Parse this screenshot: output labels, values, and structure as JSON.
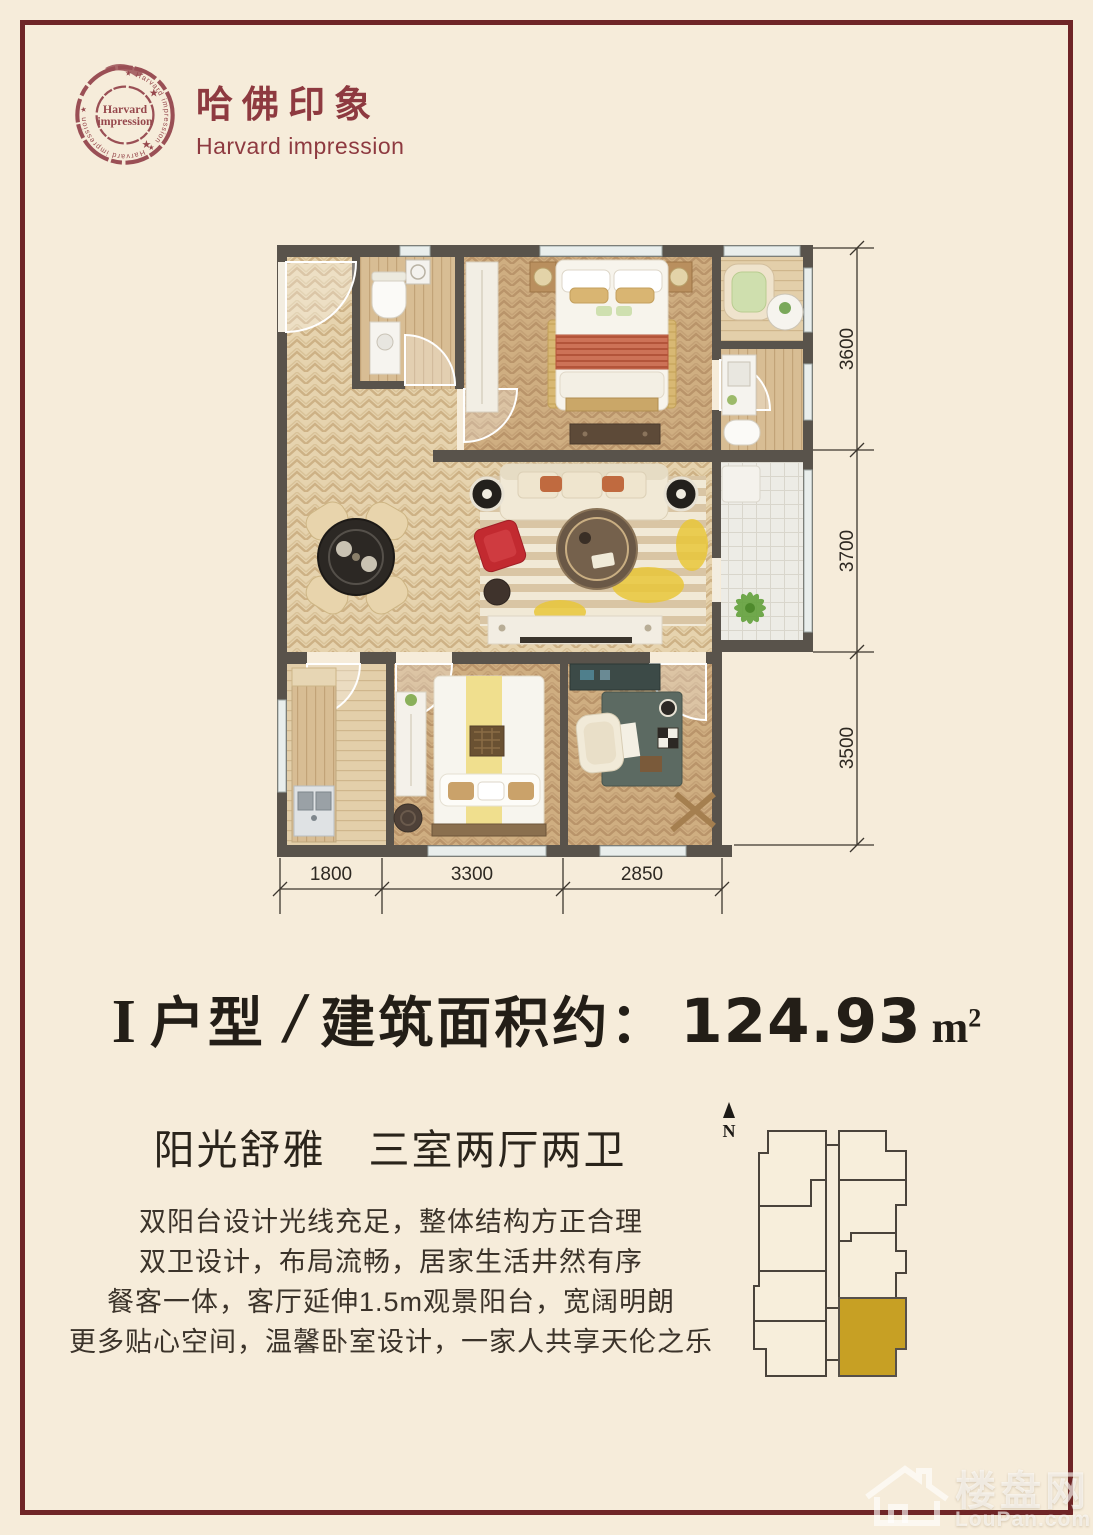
{
  "brand": {
    "logo_zh": "哈佛印象",
    "logo_en": "Harvard impression",
    "stamp_line1": "Harvard",
    "stamp_line2": "impression",
    "stamp_ring": "★ Harvard impression ★ Harvard impression ★",
    "star": "★"
  },
  "plan": {
    "dims_right": [
      "3600",
      "3700",
      "3500"
    ],
    "dims_bottom": [
      "1800",
      "3300",
      "2850"
    ]
  },
  "title": {
    "type_roman": "I",
    "type_label": "户型",
    "separator": "/",
    "area_label": "建筑面积约：",
    "area_value": "124.93",
    "unit_base": "m",
    "unit_sup": "2"
  },
  "tagline": "阳光舒雅　三室两厅两卫",
  "features": [
    "双阳台设计光线充足，整体结构方正合理",
    "双卫设计，布局流畅，居家生活井然有序",
    "餐客一体，客厅延伸1.5m观景阳台，宽阔明朗",
    "更多贴心空间，温馨卧室设计，一家人共享天伦之乐"
  ],
  "keyplan": {
    "north_label": "N"
  },
  "watermark": {
    "zh": "楼盘网",
    "en": "LouPan.com"
  },
  "colors": {
    "background": "#f6ecda",
    "frame": "#6f2527",
    "brand_red": "#8e3a40",
    "ink": "#231e17",
    "wall": "#59534b",
    "unit_highlight": "#c7a024"
  }
}
